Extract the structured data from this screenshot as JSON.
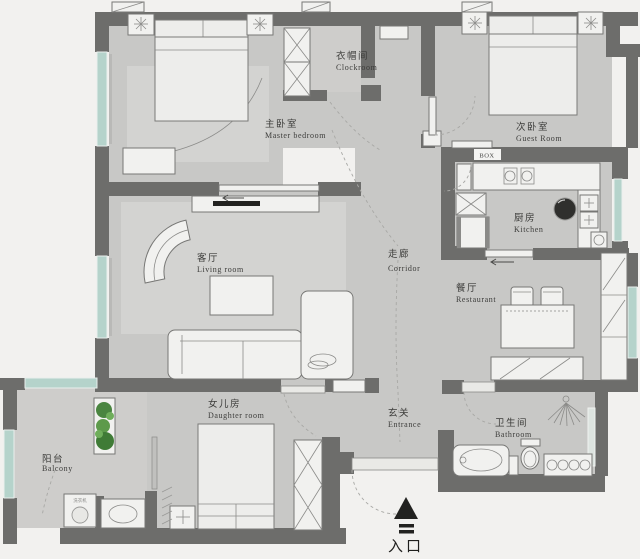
{
  "floorplan": {
    "title": "apartment-floor-plan",
    "rooms": {
      "master_bedroom": {
        "zh": "主卧室",
        "en": "Master bedroom"
      },
      "cloakroom": {
        "zh": "衣帽间",
        "en": "Clockroom"
      },
      "guest_room": {
        "zh": "次卧室",
        "en": "Guest Room"
      },
      "kitchen": {
        "zh": "厨房",
        "en": "Kitchen"
      },
      "corridor": {
        "zh": "走廊",
        "en": "Corridor"
      },
      "living_room": {
        "zh": "客厅",
        "en": "Living room"
      },
      "restaurant": {
        "zh": "餐厅",
        "en": "Restaurant"
      },
      "daughter_room": {
        "zh": "女儿房",
        "en": "Daughter room"
      },
      "entrance_hall": {
        "zh": "玄关",
        "en": "Entrance"
      },
      "bathroom": {
        "zh": "卫生间",
        "en": "Bathroom"
      },
      "balcony": {
        "zh": "阳台",
        "en": "Balcony"
      }
    },
    "annotations": {
      "box_label": "BOX",
      "washer_label": "洗衣机",
      "entry_label": "入口"
    },
    "colors": {
      "wall": "#6d6d6b",
      "floor": "#c8c8c6",
      "window": "#b5d3cb",
      "background": "#f2f1ef",
      "plant": "#4a8540",
      "entry_marker": "#1f1f1d"
    }
  }
}
